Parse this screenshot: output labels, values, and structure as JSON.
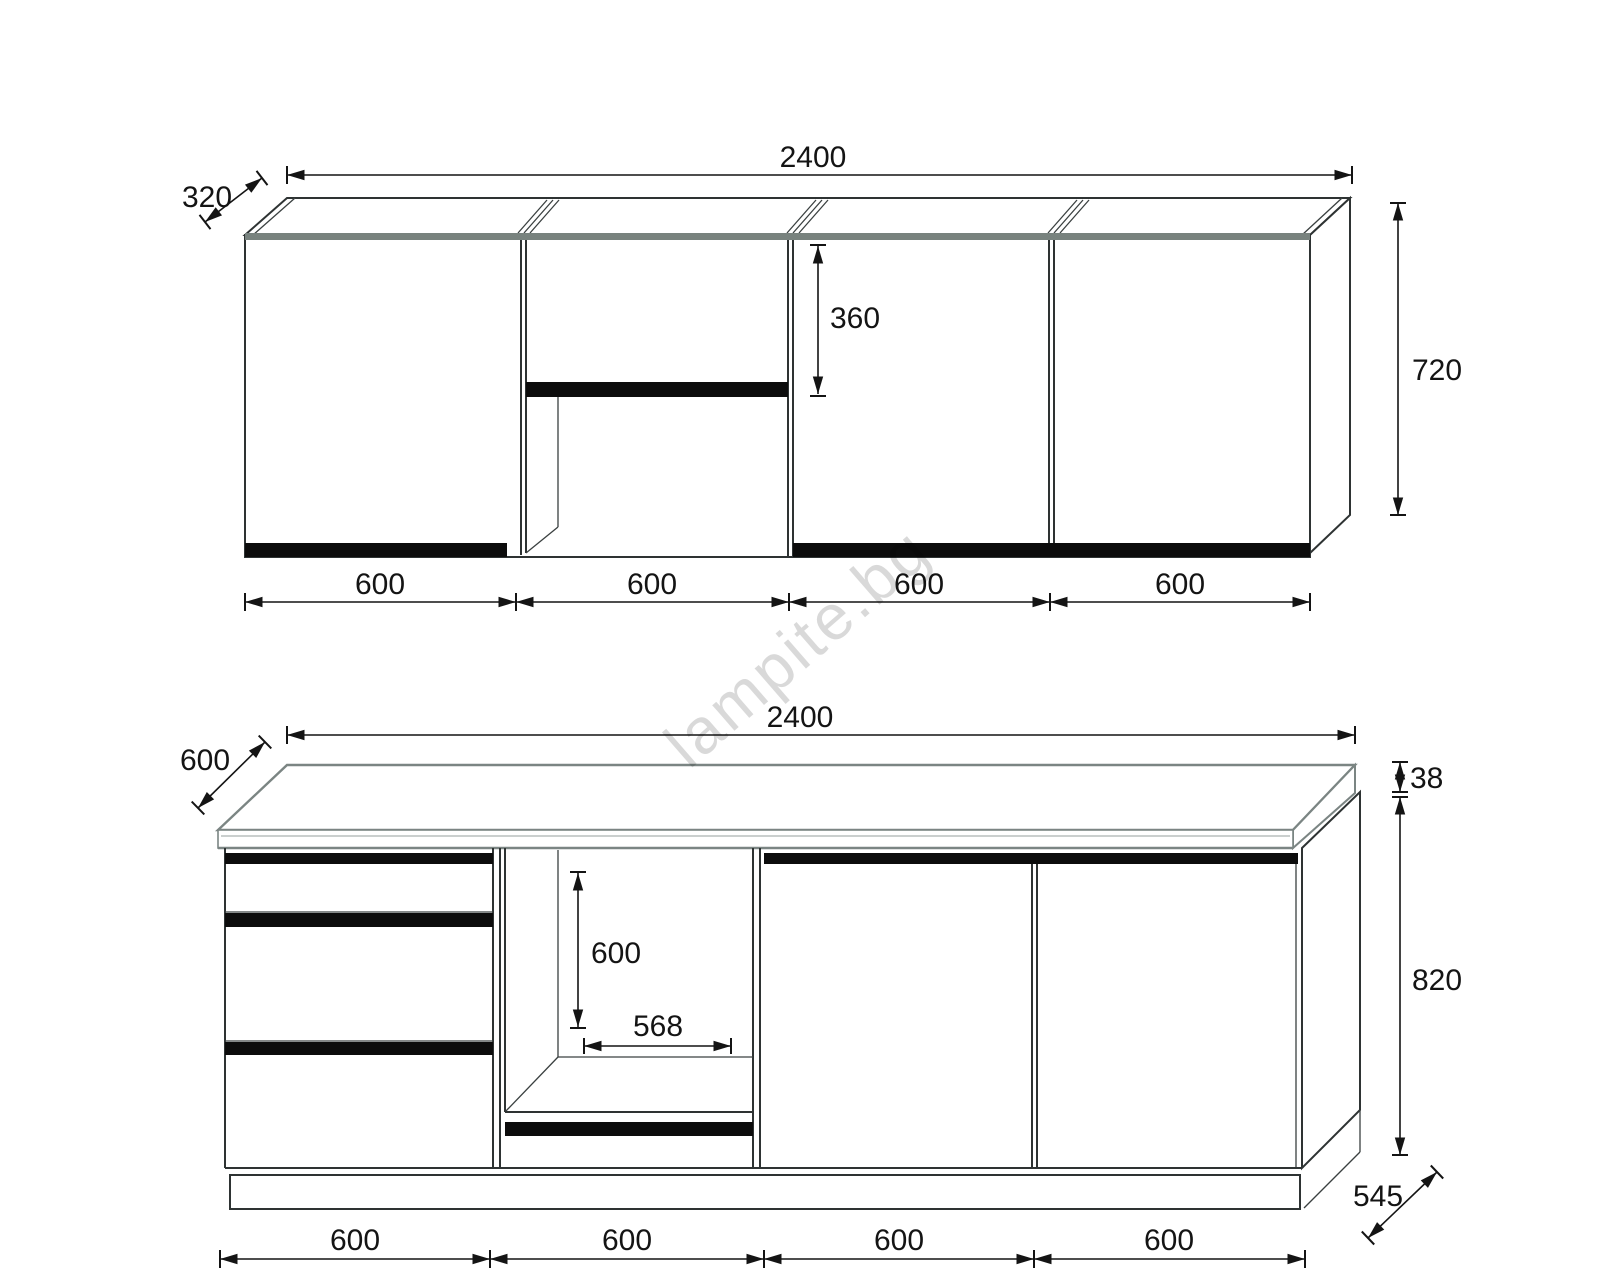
{
  "drawing": {
    "watermark": "lampite.bg",
    "colors": {
      "line": "#2e3333",
      "gray_edge": "#7b8583",
      "panel_black": "#0c0c0c",
      "dimension": "#141414",
      "watermark_gray": "#d4d4d4"
    },
    "upper_view": {
      "total_width_mm": "2400",
      "depth_mm": "320",
      "height_mm": "720",
      "hood_opening_height_mm": "360",
      "section_widths_mm": [
        "600",
        "600",
        "600",
        "600"
      ]
    },
    "lower_view": {
      "total_width_mm": "2400",
      "worktop_depth_mm": "600",
      "worktop_thickness_mm": "38",
      "body_height_mm": "820",
      "oven_niche_height_mm": "600",
      "oven_niche_width_mm": "568",
      "plinth_depth_mm": "545",
      "section_widths_mm": [
        "600",
        "600",
        "600",
        "600"
      ]
    }
  }
}
